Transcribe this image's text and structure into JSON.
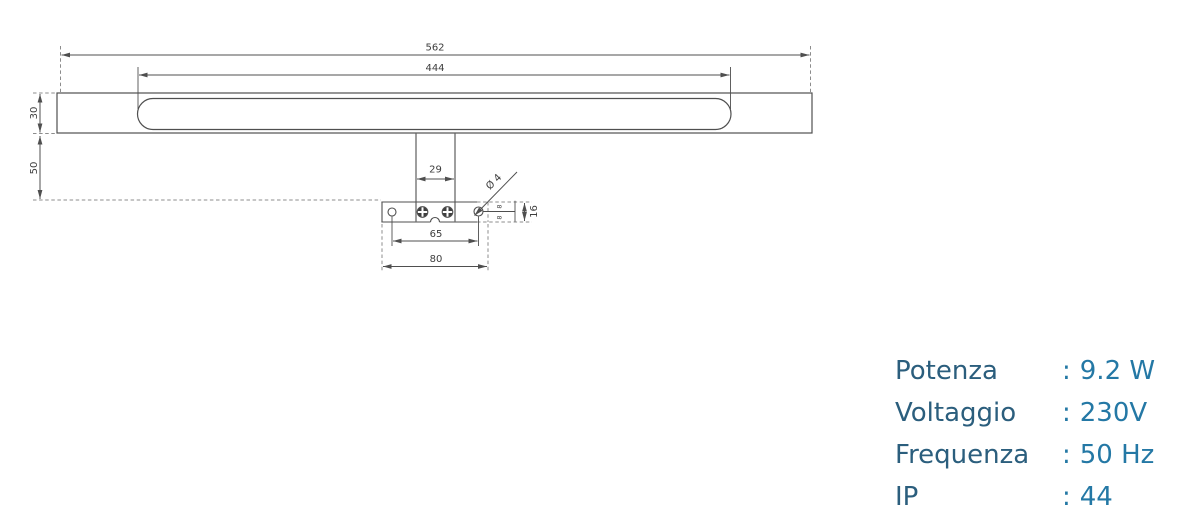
{
  "drawing": {
    "dimensions": {
      "overall_width": "562",
      "diffuser_width": "444",
      "body_height": "30",
      "mount_drop": "50",
      "stem_width": "29",
      "hole_spacing": "65",
      "plate_width": "80",
      "hole_offset_upper": "8",
      "hole_offset_lower": "8",
      "plate_depth": "16",
      "hole_diameter": "Ø 4"
    },
    "colors": {
      "outline": "#4f4f4f",
      "dashed": "#8c8c8c",
      "dim_text": "#3d3d3d"
    }
  },
  "specs": {
    "separator": ":",
    "label_color": "#2b5e7d",
    "value_color": "#2478a5",
    "rows": [
      {
        "label": "Potenza",
        "value": "9.2 W"
      },
      {
        "label": "Voltaggio",
        "value": "230V"
      },
      {
        "label": "Frequenza",
        "value": "50 Hz"
      },
      {
        "label": "IP",
        "value": "44"
      }
    ]
  }
}
